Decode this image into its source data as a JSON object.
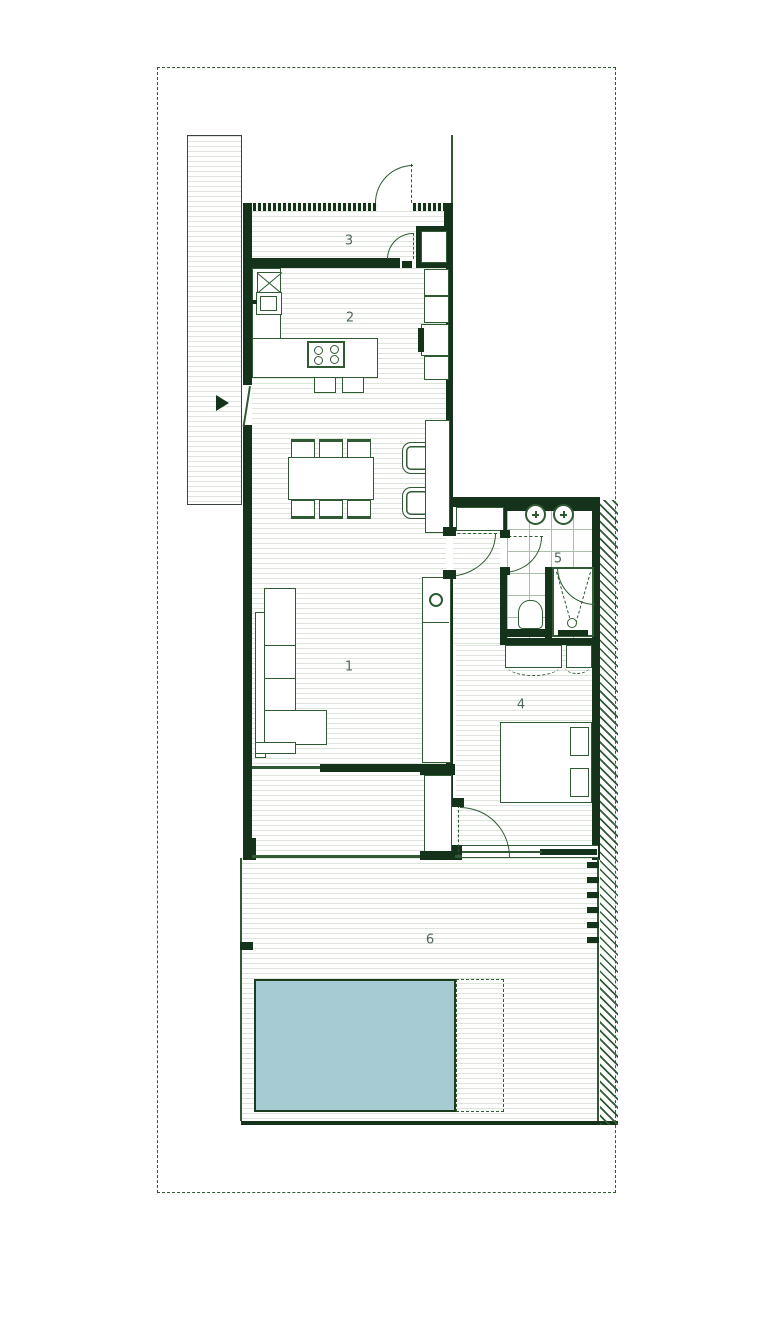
{
  "plan": {
    "type": "architectural-floor-plan",
    "labels": {
      "living": "1",
      "kitchen": "2",
      "entry": "3",
      "bedroom": "4",
      "bathroom": "5",
      "terrace": "6"
    },
    "colors": {
      "wall": "#15321a",
      "line": "#2f5a33",
      "floorline": "#dde4da",
      "tileline": "#a9bfab",
      "poolfill": "#a7cbd3",
      "poolborder": "#1b3a1e",
      "labeltext": "#51665c",
      "boundary": "#2f5a33",
      "paper": "#ffffff"
    }
  }
}
